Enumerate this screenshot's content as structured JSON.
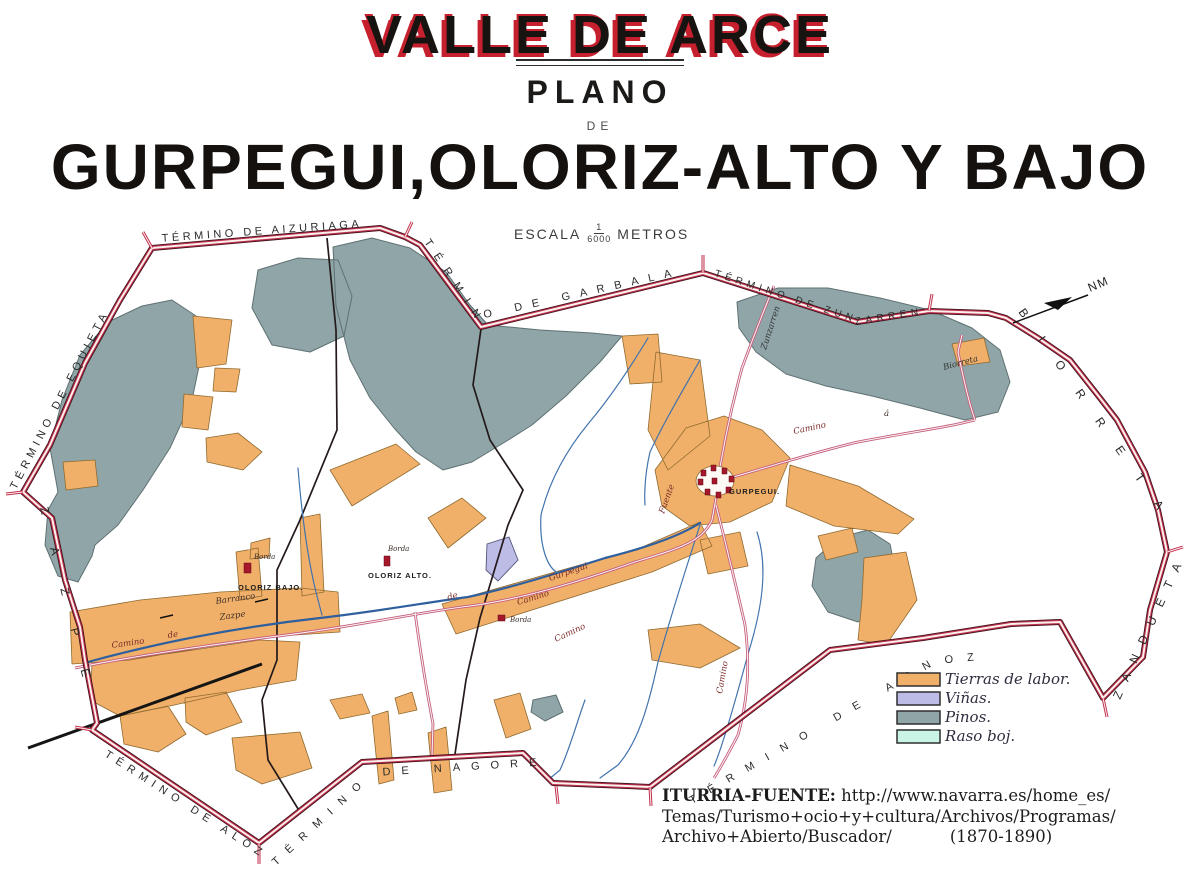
{
  "title": {
    "main": "VALLE DE ARCE",
    "plano": "PLANO",
    "de": "DE",
    "subtitle": "GURPEGUI,OLORIZ-ALTO Y BAJO"
  },
  "scale": {
    "escala": "ESCALA",
    "numerator": "1",
    "denominator": "6000",
    "metros": "METROS"
  },
  "compass": {
    "label": "NM"
  },
  "border_labels": {
    "equieta": "TÉRMINO DE EQUIETA",
    "aizuriaga": "TÉRMINO DE AIZURIAGA",
    "garbala": "TÉRMINO DE GARBALA",
    "zunzarren": "TÉRMINO DE ZUNZARREN",
    "biorreta": "BIORRETA",
    "zandueta": "ZANDUETA",
    "asnoz": "TÉRMINO DE ASNOZ",
    "nagore": "TÉRMINO DE NAGORE",
    "aloz": "TÉRMINO DE ALOZ",
    "zazpe": "ZAZPE"
  },
  "places": {
    "gurpegui": "GURPEGUI.",
    "oloriz_alto": "OLORIZ ALTO.",
    "oloriz_bajo": "OLORIZ BAJO."
  },
  "annotations": {
    "barranco": "Barranco",
    "zazpe": "Zazpe",
    "camino": "Camino",
    "de": "de",
    "gurpegui": "Gurpegui",
    "borda": "Borda",
    "fuente": "Fuente",
    "zunzarren": "Zunzarren",
    "biorreta": "Biorreta",
    "a": "á"
  },
  "legend": {
    "items": [
      {
        "label": "Tierras de labor.",
        "color": "#f1b069"
      },
      {
        "label": "Viñas.",
        "color": "#bdbce6"
      },
      {
        "label": "Pinos.",
        "color": "#8fa5a7"
      },
      {
        "label": "Raso boj.",
        "color": "#c9f4e6"
      }
    ]
  },
  "source": {
    "label": "ITURRIA-FUENTE:",
    "line1": " http://www.navarra.es/home_es/",
    "line2": "Temas/Turismo+ocio+y+cultura/Archivos/Programas/",
    "line3": "Archivo+Abierto/Buscador/",
    "years": "(1870-1890)"
  },
  "colors": {
    "title_red": "#c6202e",
    "border_red": "#c03050",
    "map_ground": "#c5f1e1",
    "river_blue": "#2e5f9e",
    "camino_pink": "#c4597e"
  }
}
